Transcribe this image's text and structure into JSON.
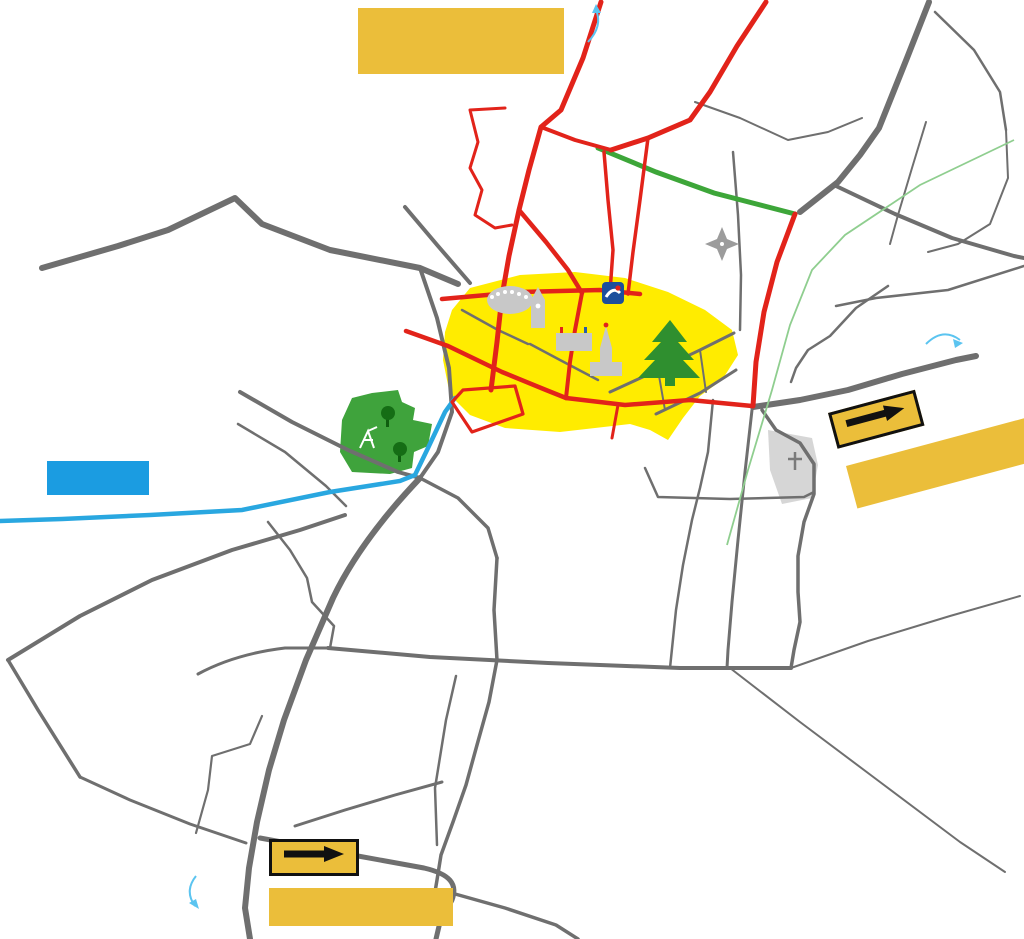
{
  "banners": {
    "closure": {
      "lines": [
        "Route RD981 entre",
        "Givry et Germolles",
        "fermée de 6h à 18h"
      ]
    },
    "until": {
      "lines": [
        "Jusqu'à la rue",
        "de la Barraude"
      ]
    },
    "deviation_right": {
      "label": "Déviation",
      "date_lines": [
        "A partir du jeudi",
        "26/03 à 12h"
      ]
    },
    "deviation_bottom": {
      "label": "Déviation",
      "date_lines": [
        "A partir du jeudi",
        "26/03 à 12h"
      ]
    }
  },
  "cities": [
    {
      "name": "Chagny",
      "x": 552,
      "y": 14
    },
    {
      "name": "Chalon",
      "x": 929,
      "y": 352
    },
    {
      "name": "Buxy",
      "x": 224,
      "y": 895
    }
  ],
  "landmarks": [
    {
      "name": "La Poste",
      "x": 578,
      "y": 293,
      "size": 13,
      "pill": true
    },
    {
      "name": "Halle\nRonde",
      "x": 508,
      "y": 314,
      "size": 12,
      "pill": true
    },
    {
      "name": "Porte de\nl'horloge",
      "x": 550,
      "y": 329,
      "size": 10.5,
      "pill": true
    },
    {
      "name": "Mairie",
      "x": 574,
      "y": 351,
      "size": 11,
      "pill": true
    },
    {
      "name": "Église",
      "x": 610,
      "y": 374,
      "size": 12,
      "pill": true
    },
    {
      "name": "Place d'Armes",
      "x": 688,
      "y": 372,
      "size": 10.5,
      "pill": false
    },
    {
      "name": "Cèdre\nplanté\nen 1919",
      "x": 669,
      "y": 353,
      "size": 7,
      "pill": false,
      "color": "#FFFFFF"
    },
    {
      "name": "Cimetière",
      "x": 794,
      "y": 480,
      "size": 6.5,
      "pill": false,
      "color": "#777777"
    }
  ],
  "streets": [
    {
      "name": "Rue de Beaune",
      "x": 556,
      "y": 64,
      "rot": -70,
      "size": 11
    },
    {
      "name": "Rue du Chemin de la Brûlée",
      "x": 722,
      "y": 48,
      "rot": -51,
      "size": 10
    },
    {
      "name": "Rue de Dracy",
      "x": 830,
      "y": 150,
      "rot": -64,
      "size": 13
    },
    {
      "name": "Imp. Ez Ouart",
      "x": 812,
      "y": 102,
      "rot": 10,
      "size": 6.5
    },
    {
      "name": "Rue des Tilles",
      "x": 928,
      "y": 142,
      "rot": -72,
      "size": 6.5
    },
    {
      "name": "Rue du Puits\nBréchet",
      "x": 592,
      "y": 120,
      "rot": 10,
      "size": 10.5
    },
    {
      "name": "Clos Marolles",
      "x": 497,
      "y": 126,
      "rot": 27,
      "size": 7
    },
    {
      "name": "Rue du Puits\nBréchet",
      "x": 770,
      "y": 196,
      "rot": 9,
      "size": 10.5
    },
    {
      "name": "Rue de la Croix Vernier",
      "x": 928,
      "y": 222,
      "rot": 16,
      "size": 11
    },
    {
      "name": "Rue des lauriers",
      "x": 915,
      "y": 274,
      "rot": 2,
      "size": 11
    },
    {
      "name": "Rue des érables",
      "x": 834,
      "y": 307,
      "rot": -36,
      "size": 10
    },
    {
      "name": "Voie verte",
      "x": 784,
      "y": 323,
      "rot": -72,
      "size": 6,
      "color": "#7CBF7C"
    },
    {
      "name": "Rue des\nBois chevaux",
      "x": 310,
      "y": 262,
      "rot": 10,
      "size": 11
    },
    {
      "name": "Rue de Varanges",
      "x": 460,
      "y": 283,
      "rot": 8,
      "size": 6.5
    },
    {
      "name": "Bd de Metz",
      "x": 549,
      "y": 254,
      "rot": 36,
      "size": 11
    },
    {
      "name": "Rue du Cellier aux Moines",
      "x": 600,
      "y": 200,
      "rot": -80,
      "size": 6
    },
    {
      "name": "Rue Georges Clemenceau",
      "x": 636,
      "y": 212,
      "rot": -75,
      "size": 7.5
    },
    {
      "name": "Rue Pasteur",
      "x": 500,
      "y": 372,
      "rot": 21,
      "size": 12
    },
    {
      "name": "Rue E. Gauthey",
      "x": 578,
      "y": 411,
      "rot": 14,
      "size": 11
    },
    {
      "name": "Bd de Verdun",
      "x": 492,
      "y": 406,
      "rot": 38,
      "size": 7
    },
    {
      "name": "Rue de la République",
      "x": 462,
      "y": 364,
      "rot": -80,
      "size": 5.5
    },
    {
      "name": "Avenue de Chalon",
      "x": 855,
      "y": 382,
      "rot": -9,
      "size": 13.5
    },
    {
      "name": "Avenue de Chalon",
      "x": 702,
      "y": 400,
      "rot": 2,
      "size": 5.5,
      "color": "#E2231A"
    },
    {
      "name": "Rue de Dracy",
      "x": 736,
      "y": 340,
      "rot": -77,
      "size": 12
    },
    {
      "name": "Rue du Bois",
      "x": 706,
      "y": 452,
      "rot": -84,
      "size": 8
    },
    {
      "name": "Rue du Pré Beau",
      "x": 812,
      "y": 458,
      "rot": -68,
      "size": 7.5
    },
    {
      "name": "Rue du Pré Beau",
      "x": 774,
      "y": 572,
      "rot": -85,
      "size": 9
    },
    {
      "name": "Rue de Cluny",
      "x": 434,
      "y": 436,
      "rot": -62,
      "size": 9.5
    },
    {
      "name": "Chemin du Charolais",
      "x": 288,
      "y": 410,
      "rot": 33,
      "size": 7
    },
    {
      "name": "Rue du charolais",
      "x": 286,
      "y": 447,
      "rot": 34,
      "size": 7
    },
    {
      "name": "Rue Armand Caillet",
      "x": 378,
      "y": 453,
      "rot": 11,
      "size": 7,
      "color": "#6E6E6E"
    },
    {
      "name": "Rue du Clos Salomon",
      "x": 199,
      "y": 500,
      "rot": 0,
      "size": 12.5
    },
    {
      "name": "Rue des Tamaris",
      "x": 162,
      "y": 584,
      "rot": -27,
      "size": 9
    },
    {
      "name": "Rue de Corchevreaux",
      "x": 306,
      "y": 578,
      "rot": -72,
      "size": 8
    },
    {
      "name": "Avenue de Mortières",
      "x": 347,
      "y": 586,
      "rot": -56,
      "size": 13.5
    },
    {
      "name": "Rue du  Pied du clou",
      "x": 248,
      "y": 656,
      "rot": -5,
      "size": 8.5
    },
    {
      "name": "Rue de l'Arcy",
      "x": 582,
      "y": 640,
      "rot": 0,
      "size": 11
    },
    {
      "name": "Rue des Mouillères",
      "x": 510,
      "y": 644,
      "rot": -80,
      "size": 6.5
    },
    {
      "name": "Rue du Clos du Roy",
      "x": 450,
      "y": 767,
      "rot": -78,
      "size": 9
    },
    {
      "name": "Rue des  Mouillères",
      "x": 472,
      "y": 790,
      "rot": -76,
      "size": 9
    },
    {
      "name": "Rue des\nMouillères",
      "x": 352,
      "y": 812,
      "rot": 20,
      "size": 9.5
    },
    {
      "name": "Avenue de Mortières",
      "x": 282,
      "y": 778,
      "rot": -66,
      "size": 13
    },
    {
      "name": "Rue de Sauges",
      "x": 140,
      "y": 796,
      "rot": 20,
      "size": 9
    },
    {
      "name": "Impasse des Sauges",
      "x": 218,
      "y": 738,
      "rot": 6,
      "size": 6.5
    }
  ],
  "compass": {
    "n": "N",
    "e": "E",
    "s": "S",
    "o": "O"
  },
  "arrows": [
    {
      "x": 910,
      "y": 12,
      "rot": 128
    },
    {
      "x": 920,
      "y": 42,
      "rot": -75
    },
    {
      "x": 886,
      "y": 68,
      "rot": 124
    },
    {
      "x": 888,
      "y": 102,
      "rot": -58
    },
    {
      "x": 868,
      "y": 118,
      "rot": 4
    },
    {
      "x": 906,
      "y": 136,
      "rot": 128
    },
    {
      "x": 843,
      "y": 170,
      "rot": -58
    },
    {
      "x": 878,
      "y": 192,
      "rot": 184
    },
    {
      "x": 948,
      "y": 208,
      "rot": 184
    },
    {
      "x": 872,
      "y": 220,
      "rot": 28
    },
    {
      "x": 918,
      "y": 236,
      "rot": 28
    },
    {
      "x": 916,
      "y": 368,
      "rot": -11
    },
    {
      "x": 893,
      "y": 400,
      "rot": 2
    },
    {
      "x": 779,
      "y": 484,
      "rot": 96
    },
    {
      "x": 806,
      "y": 520,
      "rot": -84
    },
    {
      "x": 793,
      "y": 600,
      "rot": -80
    },
    {
      "x": 772,
      "y": 614,
      "rot": 100
    },
    {
      "x": 800,
      "y": 654,
      "rot": -76
    },
    {
      "x": 553,
      "y": 646,
      "rot": 184
    },
    {
      "x": 552,
      "y": 674,
      "rot": 2
    },
    {
      "x": 648,
      "y": 650,
      "rot": 184
    },
    {
      "x": 652,
      "y": 676,
      "rot": 2
    },
    {
      "x": 720,
      "y": 652,
      "rot": 184
    },
    {
      "x": 856,
      "y": 646,
      "rot": 190
    },
    {
      "x": 496,
      "y": 666,
      "rot": 96
    },
    {
      "x": 514,
      "y": 716,
      "rot": -84
    },
    {
      "x": 695,
      "y": 776,
      "rot": 140
    },
    {
      "x": 690,
      "y": 830,
      "rot": 36
    },
    {
      "x": 318,
      "y": 822,
      "rot": -160
    },
    {
      "x": 260,
      "y": 842,
      "rot": 110
    },
    {
      "x": 251,
      "y": 886,
      "rot": 110
    },
    {
      "x": 428,
      "y": 888,
      "rot": -146
    },
    {
      "x": 400,
      "y": 896,
      "rot": 34
    },
    {
      "x": 456,
      "y": 836,
      "rot": 134
    },
    {
      "x": 452,
      "y": 892,
      "rot": -82
    }
  ],
  "colors": {
    "closed_road": "#E2231A",
    "deviation_green": "#3DA639",
    "road_gray": "#6F6F6F",
    "route_blue": "#29A7E0",
    "zone_yellow": "#FFEC00",
    "banner_gold": "#EBBE3A",
    "banner_blue": "#1B9CE1",
    "city_blue": "#5BC4F0",
    "park_green": "#3FA33C",
    "voie_verte_green": "#8FCE8F",
    "arrow_black": "#111111"
  }
}
